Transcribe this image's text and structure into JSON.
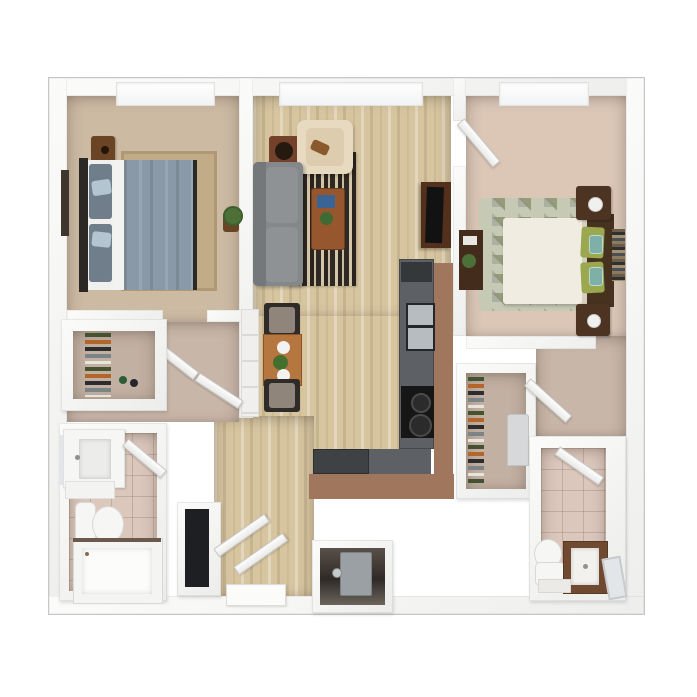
{
  "scene": {
    "type": "3d-floor-plan-rendering",
    "view": "top-down dollhouse",
    "description": "Furnished two-bedroom, two-bathroom apartment floor plan rendering on a white background",
    "background": "#ffffff",
    "frame_border": "#c7c7c7"
  },
  "palette": {
    "wall": "#f5f5f4",
    "carpet_tan": "#cdbaa3",
    "rug_tan": "#c2ab87",
    "carpet_pink": "#dcc7b7",
    "carpet_taupe": "#c8b6a8",
    "closet_floor": "#c2b0a2",
    "wood_floor": "#d7c5a0",
    "tile_pink": "#dbc7bc",
    "counter_gray": "#5d6165",
    "counter_dark": "#3f4245",
    "appliance_dark": "#35383b",
    "bar_brown": "#a0775c",
    "stove_black": "#161616",
    "sink_steel": "#b7bcc1",
    "sofa_gray": "#85888b",
    "sofa_seat": "#8f9295",
    "armchair_beige": "#e7dac1",
    "armchair_cushion": "#ddcdae",
    "throw_brown": "#8a5a2e",
    "coffee_table": "#96572e",
    "book_blue": "#3a6396",
    "tv_console": "#53301b",
    "tv_black": "#121212",
    "speaker_brown": "#74422a",
    "duvet_blue": "#8a99a7",
    "pillow_gray": "#6f7e8a",
    "pillow_blue": "#b2c5d1",
    "sheet_white": "#f2f2f0",
    "headboard_dark": "#2b2825",
    "nightstand_brown": "#6b4426",
    "lamp_glow": "#f0a85a",
    "mattress_cream": "#f0ece1",
    "headboard2_brown": "#46321f",
    "pillow_green": "#9aa850",
    "pillow_teal": "#7fb0a8",
    "nightstand2_brown": "#4c3322",
    "desk_brown": "#432c1c",
    "table_wood": "#b5763f",
    "chair_frame": "#2e2b28",
    "chair_seat": "#8f857b",
    "fridge_white": "#f0efed",
    "vanity_brown": "#6f4a30",
    "mirror_gray": "#e3e6e8",
    "fixture_white": "#f6f6f4",
    "rug_diamond_base": "#c6c9b4",
    "heater_gray": "#9aa0a4",
    "utility_dark": "#3a332e",
    "plant_green": "#4c7038",
    "plate_white": "#f2f2f0",
    "mat_white": "#fbfbfa"
  },
  "rooms": [
    {
      "id": "bedroom-1",
      "label": "bedroom 1",
      "floor": "tan carpet"
    },
    {
      "id": "living-room",
      "label": "living room",
      "floor": "light wood"
    },
    {
      "id": "kitchen",
      "label": "kitchen",
      "floor": "light wood"
    },
    {
      "id": "dining-nook",
      "label": "dining nook",
      "floor": "light wood"
    },
    {
      "id": "bedroom-2",
      "label": "bedroom 2",
      "floor": "pink-beige carpet"
    },
    {
      "id": "bathroom-1",
      "label": "bathroom 1",
      "floor": "pink tile"
    },
    {
      "id": "bathroom-2",
      "label": "bathroom 2",
      "floor": "pink tile"
    },
    {
      "id": "walk-in-closet-1",
      "label": "walk-in closet 1",
      "floor": "taupe carpet"
    },
    {
      "id": "walk-in-closet-2",
      "label": "walk-in closet 2",
      "floor": "taupe carpet"
    },
    {
      "id": "hallway-left",
      "label": "left hallway",
      "floor": "taupe carpet"
    },
    {
      "id": "hallway-right",
      "label": "right hallway",
      "floor": "taupe carpet"
    },
    {
      "id": "entry-hall",
      "label": "entry hall",
      "floor": "light wood"
    },
    {
      "id": "utility-closet",
      "label": "utility closet",
      "floor": "dark"
    },
    {
      "id": "linen-closet",
      "label": "linen closet",
      "floor": "shelving"
    }
  ],
  "furniture": {
    "bedroom_1": [
      "queen bed with gray-blue duvet",
      "two light-blue accent pillows",
      "dark headboard",
      "wood nightstand",
      "table lamp glowing",
      "wall shelf art",
      "area rug",
      "potted plant"
    ],
    "living_room": [
      "gray sofa",
      "beige armchair",
      "brown throw",
      "striped area rug",
      "wood coffee table",
      "blue book",
      "small plant",
      "tv console",
      "flat tv",
      "speaker cabinet"
    ],
    "kitchen": [
      "gray counter run",
      "double sink",
      "range with burners",
      "dark lower cabinets",
      "breakfast bar",
      "refrigerator"
    ],
    "dining_nook": [
      "wood dining table",
      "two chairs",
      "two place settings",
      "centerpiece plant"
    ],
    "bedroom_2": [
      "queen bed with cream duvet",
      "green pillows",
      "teal patterned pillows",
      "dark headboard with books",
      "two nightstands with white lamps",
      "diamond pattern rug",
      "desk with plant"
    ],
    "bathroom_1": [
      "vanity with sink",
      "mirror",
      "wall cabinet",
      "toilet",
      "bathtub with glass screen"
    ],
    "bathroom_2": [
      "toilet",
      "brown vanity with sink",
      "leaning mirror",
      "bath mat"
    ],
    "closets": [
      "hanging clothes rods",
      "stacked linens",
      "stacked shoes",
      "water heater"
    ],
    "doors": [
      "open door leaves at bedroom 2, hallways, bathrooms, closets and entry"
    ]
  },
  "windows": {
    "count": 3,
    "locations": [
      "bedroom 1 top wall",
      "living room top wall",
      "bedroom 2 top wall"
    ]
  }
}
